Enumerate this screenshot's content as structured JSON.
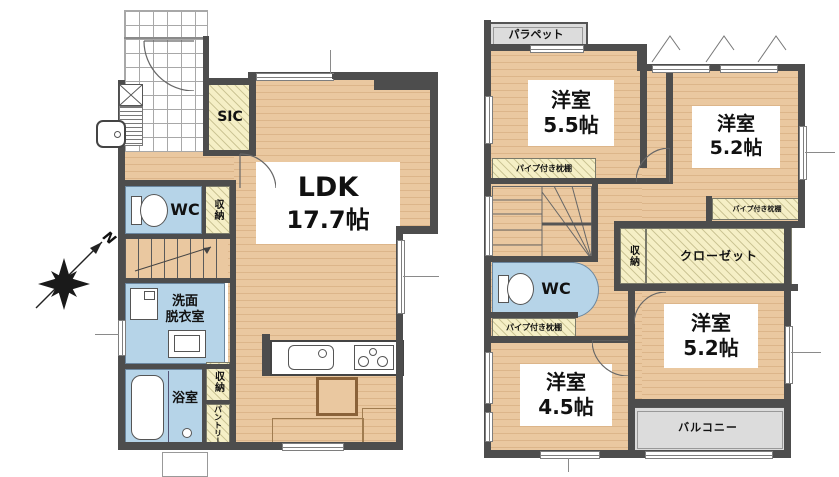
{
  "colors": {
    "wall": "#4d4d4d",
    "wood": "#eac8a0",
    "wet": "#b6d4e8",
    "storage": "#f5efc6",
    "concrete": "#dcdcdc",
    "ink": "#111111"
  },
  "compass": {
    "north": "N"
  },
  "floor1": {
    "ldk": {
      "name": "LDK",
      "area": "17.7帖"
    },
    "sic": "SIC",
    "wc": "WC",
    "wc_storage": "収納",
    "washroom": {
      "line1": "洗面",
      "line2": "脱衣室"
    },
    "bath": "浴室",
    "storage": "収納",
    "pantry": "パントリー"
  },
  "floor2": {
    "parapet": "パラペット",
    "room_nw": {
      "name": "洋室",
      "area": "5.5帖"
    },
    "room_ne": {
      "name": "洋室",
      "area": "5.2帖"
    },
    "room_se": {
      "name": "洋室",
      "area": "5.2帖"
    },
    "room_sw": {
      "name": "洋室",
      "area": "4.5帖"
    },
    "pipe_shelf_nw": "パイプ付き枕棚",
    "pipe_shelf_ne": "パイプ付き枕棚",
    "pipe_shelf_sw": "パイプ付き枕棚",
    "storage": "収納",
    "closet": "クローゼット",
    "wc": "WC",
    "balcony": "バルコニー"
  }
}
